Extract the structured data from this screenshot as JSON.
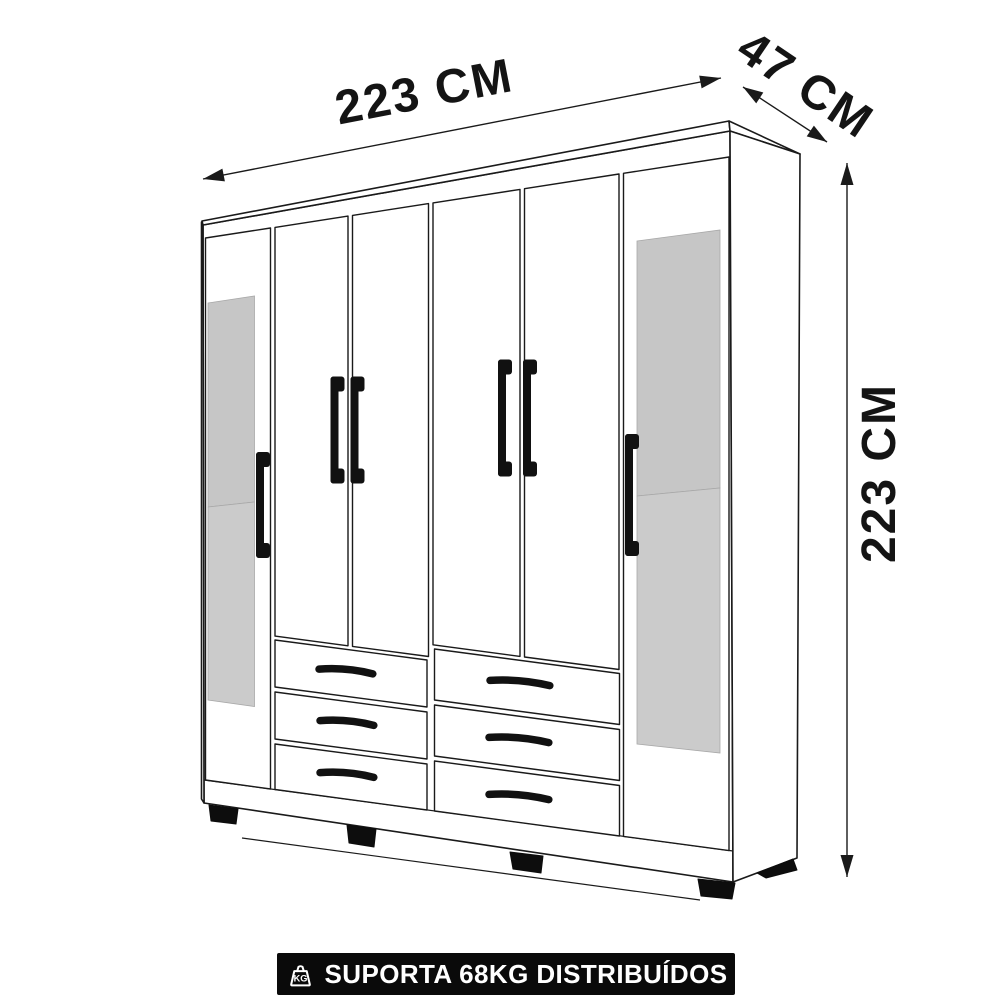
{
  "diagram": {
    "background_color": "#ffffff",
    "line_color": "#1a1a1a",
    "mirror_color_top": "#c6c6c6",
    "mirror_color_bottom": "#cbcbcb"
  },
  "dimensions": {
    "width": {
      "value": "223",
      "unit": "CM",
      "label": "223 CM"
    },
    "depth": {
      "value": "47",
      "unit": "CM",
      "label": "47 CM"
    },
    "height": {
      "value": "223",
      "unit": "CM",
      "label": "223 CM"
    }
  },
  "capacity_banner": {
    "icon": "weight-kg-icon",
    "icon_label": "KG",
    "text": "SUPORTA 68KG DISTRIBUÍDOS",
    "background_color": "#0a0a0a",
    "text_color": "#ffffff"
  }
}
